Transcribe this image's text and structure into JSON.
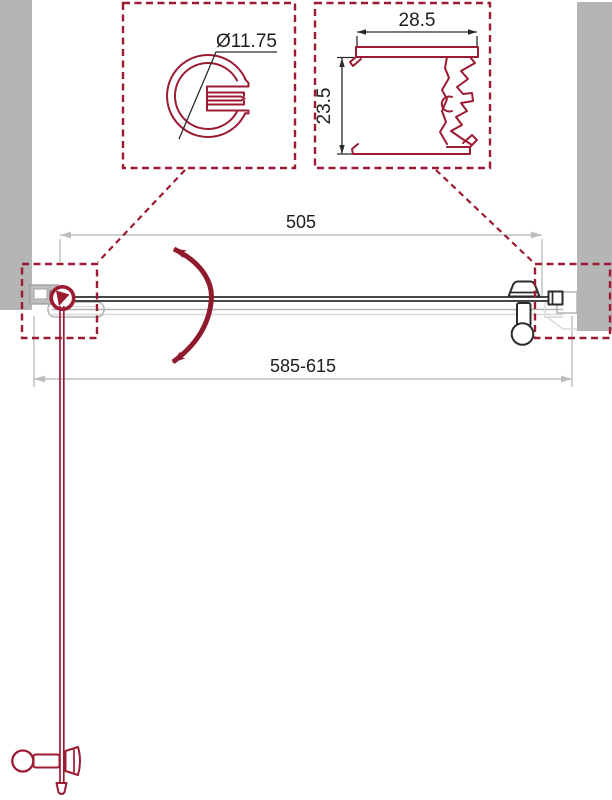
{
  "title": "Shower door technical drawing (plan view with profile details)",
  "details": {
    "hinge_profile": {
      "diameter_label": "Ø11.75"
    },
    "wall_profile": {
      "width_label": "28.5",
      "height_label": "23.5"
    }
  },
  "dimensions": {
    "glass_width": "505",
    "overall_adjustment": "585-615"
  },
  "colors": {
    "profile-maroon": "#9c1b33",
    "arc-red": "#8f1a2e",
    "wall-gray": "#b5b5b5",
    "dim-gray": "#bdbdbd",
    "detail-dim": "#2a2a2a",
    "text-black": "#1d1d1d",
    "door-black": "#2b2b2b",
    "profile-gray": "#b3b3b3",
    "profile-gray-light": "#d9d9d9"
  }
}
